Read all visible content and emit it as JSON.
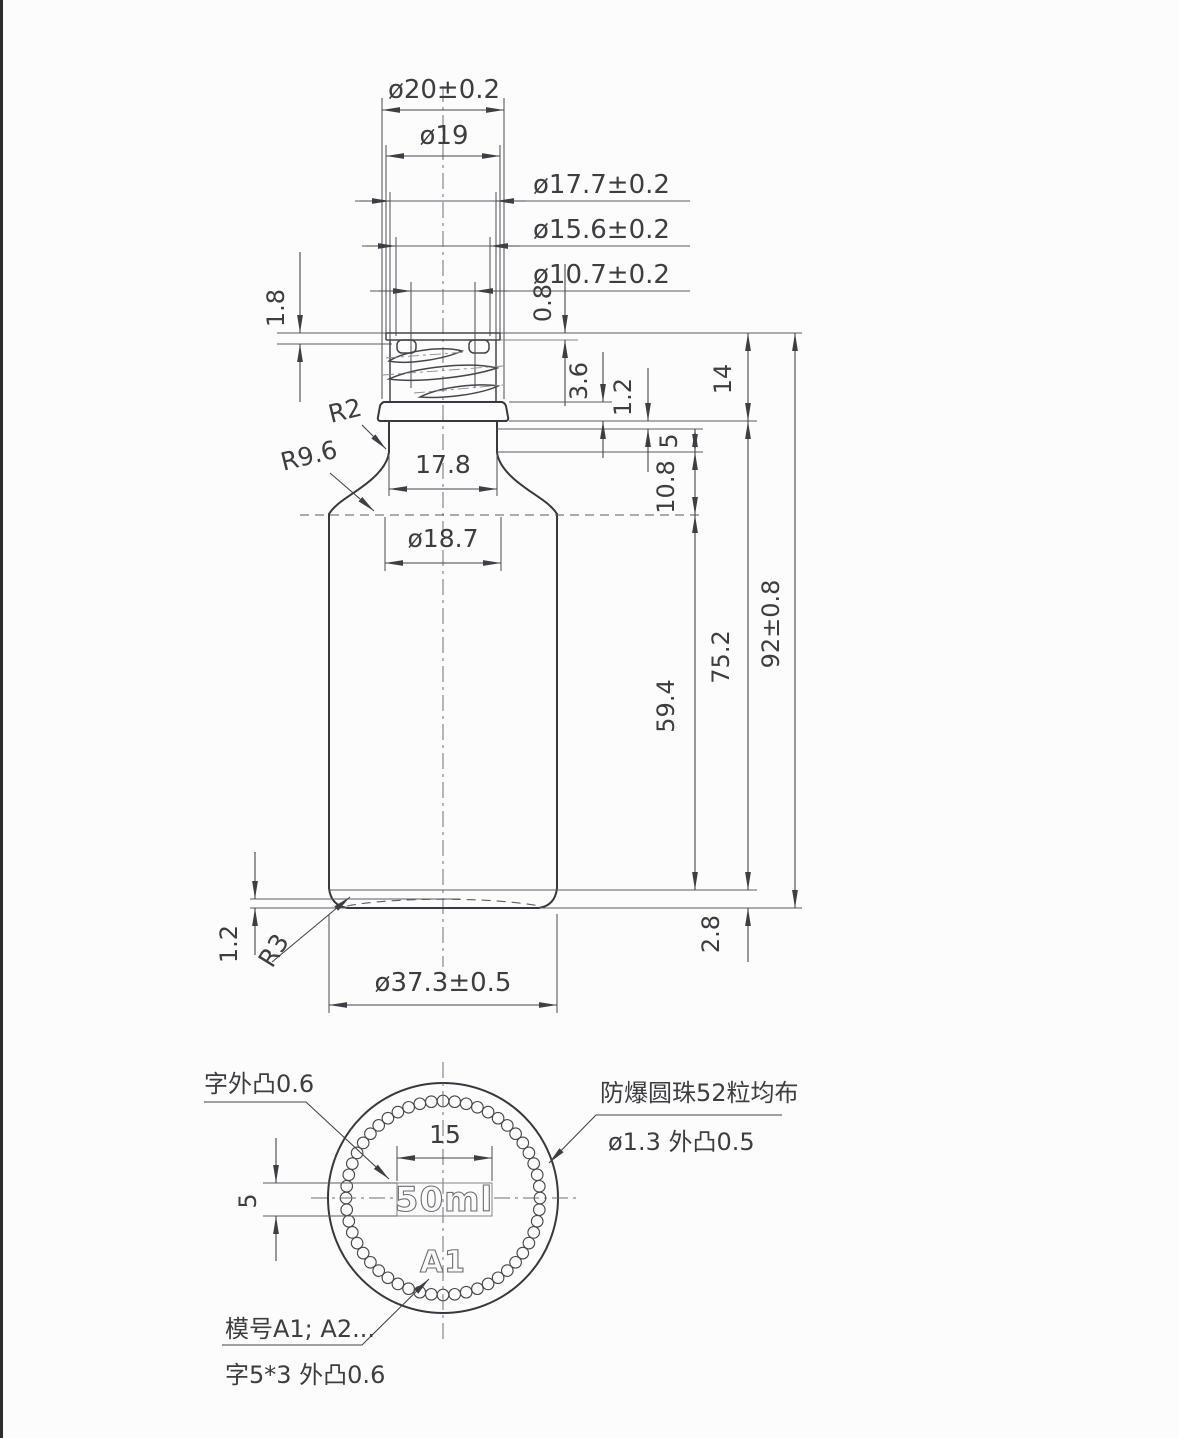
{
  "drawing": {
    "side_view": {
      "dims": {
        "d20": "ø20±0.2",
        "d19": "ø19",
        "d177": "ø17.7±0.2",
        "d156": "ø15.6±0.2",
        "d107": "ø10.7±0.2",
        "h18": "1.8",
        "h08": "0.8",
        "h36": "3.6",
        "h12": "1.2",
        "h5": "5",
        "h108": "10.8",
        "h14": "14",
        "r2": "R2",
        "r96": "R9.6",
        "w178": "17.8",
        "d187": "ø18.7",
        "h594": "59.4",
        "h752": "75.2",
        "h92": "92±0.8",
        "b12": "1.2",
        "r3": "R3",
        "b28": "2.8",
        "d373": "ø37.3±0.5"
      }
    },
    "bottom_view": {
      "note_emboss": "字外凸0.6",
      "dim15": "15",
      "dim5": "5",
      "volume": "50ml",
      "mold_id": "A1",
      "note_balls_1": "防爆圆珠52粒均布",
      "note_balls_2": "ø1.3  外凸0.5",
      "note_mold_1": "模号A1; A2...",
      "note_mold_2": "字5*3  外凸0.6",
      "ball_count": 52
    },
    "colors": {
      "line": "#38383e",
      "background": "#fcfcfc",
      "edge_border": "#2b2b30"
    }
  }
}
